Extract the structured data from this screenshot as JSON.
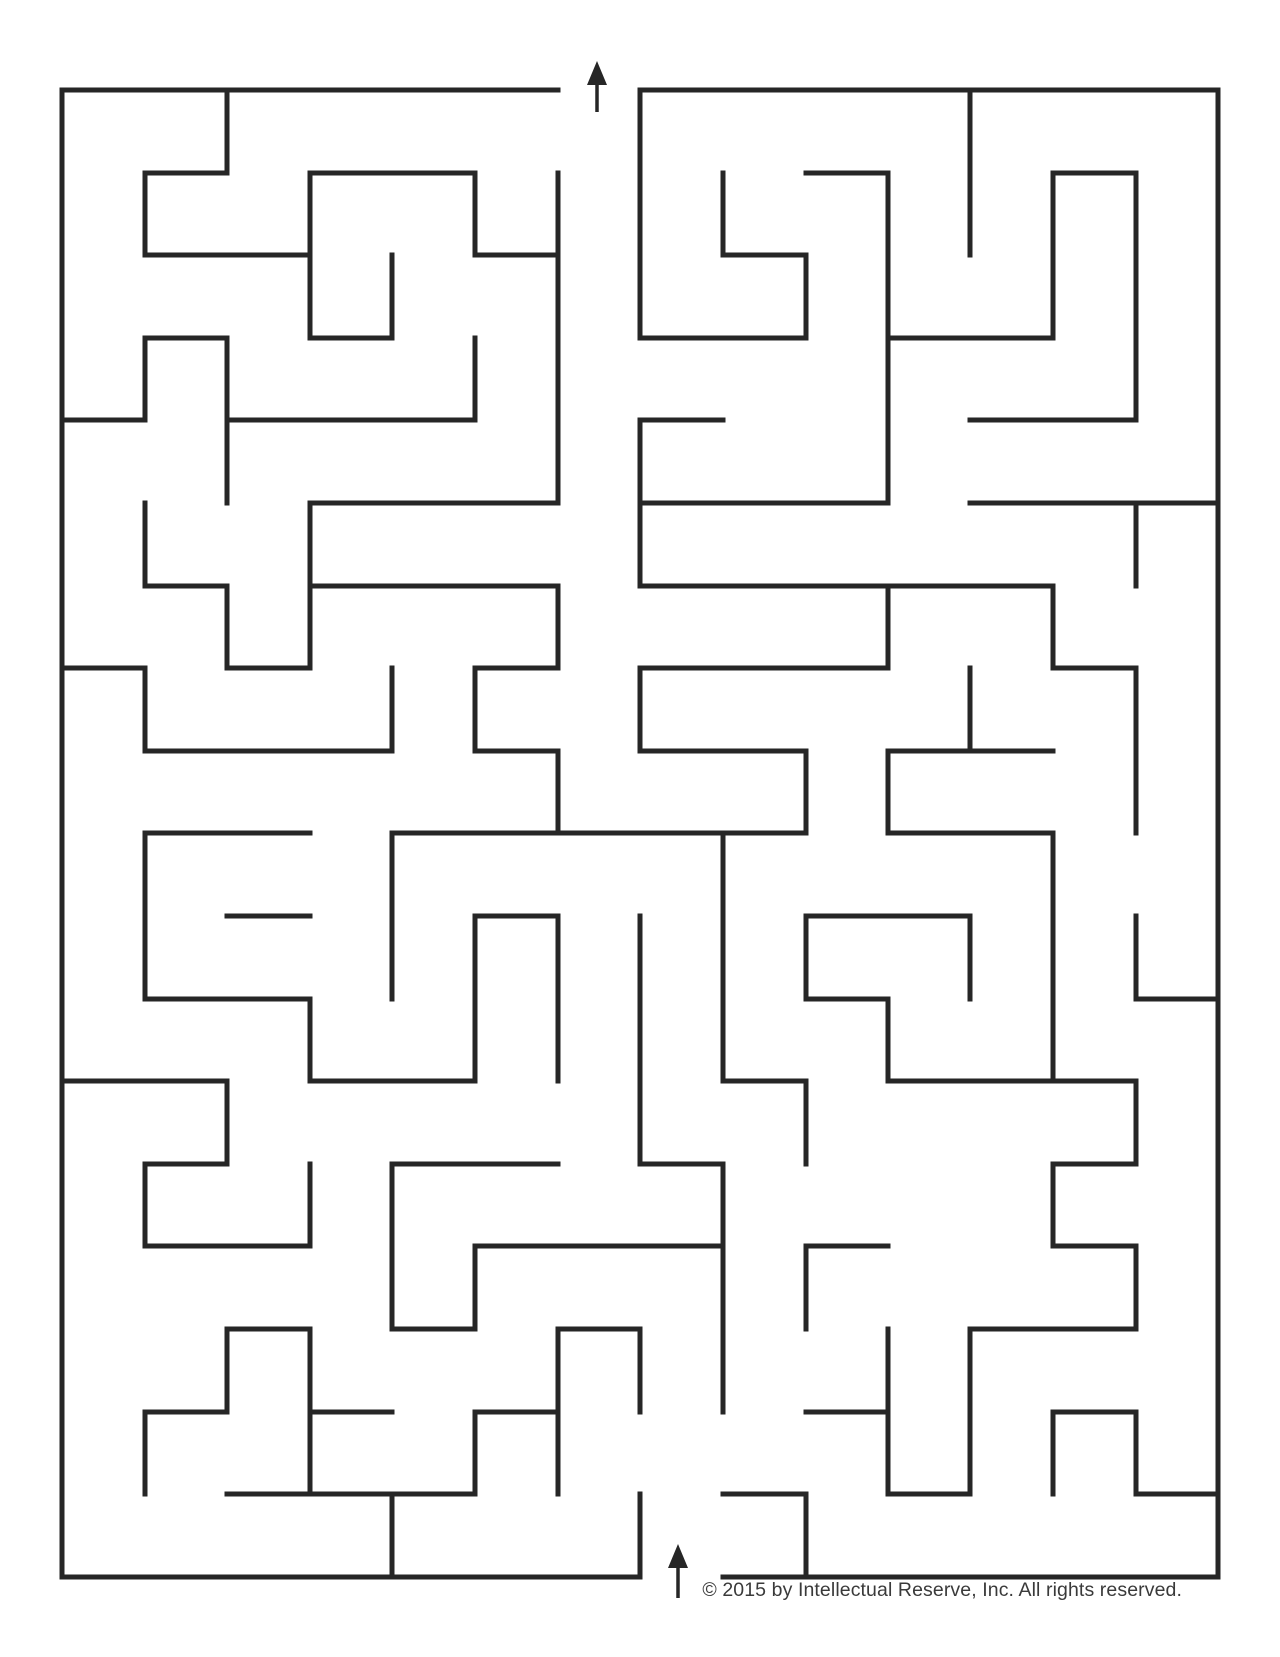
{
  "maze": {
    "width": 1280,
    "height": 1657,
    "wall_color": "#262626",
    "wall_thickness": 5,
    "cols_x": [
      62,
      145,
      227,
      310,
      392,
      475,
      558,
      640,
      723,
      806,
      888,
      970,
      1053,
      1136,
      1218
    ],
    "rows_y": [
      90,
      173,
      255,
      338,
      420,
      503,
      586,
      668,
      751,
      833,
      916,
      999,
      1081,
      1164,
      1246,
      1329,
      1412,
      1494,
      1577
    ],
    "h_walls": [
      [
        0,
        0,
        6
      ],
      [
        0,
        7,
        14
      ],
      [
        1,
        1,
        2
      ],
      [
        1,
        3,
        5
      ],
      [
        1,
        9,
        10
      ],
      [
        1,
        12,
        13
      ],
      [
        2,
        1,
        3
      ],
      [
        2,
        5,
        6
      ],
      [
        2,
        8,
        9
      ],
      [
        3,
        1,
        2
      ],
      [
        3,
        3,
        4
      ],
      [
        3,
        7,
        9
      ],
      [
        3,
        10,
        12
      ],
      [
        4,
        0,
        1
      ],
      [
        4,
        2,
        5
      ],
      [
        4,
        7,
        8
      ],
      [
        4,
        11,
        13
      ],
      [
        5,
        3,
        6
      ],
      [
        5,
        7,
        10
      ],
      [
        5,
        11,
        14
      ],
      [
        6,
        1,
        2
      ],
      [
        6,
        3,
        6
      ],
      [
        6,
        7,
        12
      ],
      [
        7,
        0,
        1
      ],
      [
        7,
        2,
        3
      ],
      [
        7,
        5,
        6
      ],
      [
        7,
        7,
        10
      ],
      [
        7,
        12,
        13
      ],
      [
        8,
        1,
        4
      ],
      [
        8,
        5,
        6
      ],
      [
        8,
        7,
        9
      ],
      [
        8,
        10,
        12
      ],
      [
        9,
        1,
        3
      ],
      [
        9,
        4,
        9
      ],
      [
        9,
        10,
        12
      ],
      [
        10,
        2,
        3
      ],
      [
        10,
        5,
        6
      ],
      [
        10,
        9,
        11
      ],
      [
        11,
        1,
        3
      ],
      [
        11,
        9,
        10
      ],
      [
        11,
        13,
        14
      ],
      [
        12,
        0,
        2
      ],
      [
        12,
        3,
        5
      ],
      [
        12,
        8,
        9
      ],
      [
        12,
        10,
        13
      ],
      [
        13,
        1,
        2
      ],
      [
        13,
        4,
        6
      ],
      [
        13,
        7,
        8
      ],
      [
        13,
        12,
        13
      ],
      [
        14,
        1,
        3
      ],
      [
        14,
        5,
        8
      ],
      [
        14,
        9,
        10
      ],
      [
        14,
        12,
        13
      ],
      [
        15,
        2,
        3
      ],
      [
        15,
        4,
        5
      ],
      [
        15,
        6,
        7
      ],
      [
        15,
        11,
        13
      ],
      [
        16,
        1,
        2
      ],
      [
        16,
        3,
        4
      ],
      [
        16,
        5,
        6
      ],
      [
        16,
        9,
        10
      ],
      [
        16,
        12,
        13
      ],
      [
        17,
        2,
        5
      ],
      [
        17,
        8,
        9
      ],
      [
        17,
        10,
        11
      ],
      [
        17,
        13,
        14
      ],
      [
        18,
        0,
        7
      ],
      [
        18,
        8,
        14
      ]
    ],
    "v_walls": [
      [
        0,
        0,
        18
      ],
      [
        1,
        1,
        2
      ],
      [
        1,
        3,
        4
      ],
      [
        1,
        5,
        6
      ],
      [
        1,
        7,
        8
      ],
      [
        1,
        9,
        11
      ],
      [
        1,
        13,
        14
      ],
      [
        1,
        16,
        17
      ],
      [
        2,
        0,
        1
      ],
      [
        2,
        3,
        5
      ],
      [
        2,
        6,
        7
      ],
      [
        2,
        12,
        13
      ],
      [
        2,
        15,
        16
      ],
      [
        3,
        1,
        3
      ],
      [
        3,
        5,
        7
      ],
      [
        3,
        11,
        12
      ],
      [
        3,
        13,
        14
      ],
      [
        3,
        15,
        17
      ],
      [
        4,
        2,
        3
      ],
      [
        4,
        7,
        8
      ],
      [
        4,
        9,
        11
      ],
      [
        4,
        13,
        15
      ],
      [
        4,
        17,
        18
      ],
      [
        5,
        1,
        2
      ],
      [
        5,
        3,
        4
      ],
      [
        5,
        7,
        8
      ],
      [
        5,
        10,
        12
      ],
      [
        5,
        14,
        15
      ],
      [
        5,
        16,
        17
      ],
      [
        6,
        1,
        5
      ],
      [
        6,
        6,
        7
      ],
      [
        6,
        8,
        9
      ],
      [
        6,
        10,
        12
      ],
      [
        6,
        15,
        17
      ],
      [
        7,
        0,
        3
      ],
      [
        7,
        4,
        6
      ],
      [
        7,
        7,
        8
      ],
      [
        7,
        10,
        13
      ],
      [
        7,
        15,
        16
      ],
      [
        7,
        17,
        18
      ],
      [
        8,
        1,
        2
      ],
      [
        8,
        9,
        12
      ],
      [
        8,
        13,
        16
      ],
      [
        9,
        2,
        3
      ],
      [
        9,
        8,
        9
      ],
      [
        9,
        10,
        11
      ],
      [
        9,
        12,
        13
      ],
      [
        9,
        14,
        15
      ],
      [
        9,
        17,
        18
      ],
      [
        10,
        1,
        5
      ],
      [
        10,
        6,
        7
      ],
      [
        10,
        8,
        9
      ],
      [
        10,
        11,
        12
      ],
      [
        10,
        15,
        17
      ],
      [
        11,
        0,
        2
      ],
      [
        11,
        7,
        8
      ],
      [
        11,
        10,
        11
      ],
      [
        11,
        15,
        17
      ],
      [
        12,
        1,
        3
      ],
      [
        12,
        6,
        7
      ],
      [
        12,
        9,
        12
      ],
      [
        12,
        13,
        14
      ],
      [
        12,
        16,
        17
      ],
      [
        13,
        1,
        4
      ],
      [
        13,
        5,
        6
      ],
      [
        13,
        7,
        9
      ],
      [
        13,
        10,
        11
      ],
      [
        13,
        12,
        13
      ],
      [
        13,
        14,
        15
      ],
      [
        13,
        16,
        17
      ],
      [
        14,
        0,
        18
      ]
    ],
    "exit_arrow": {
      "x": 597,
      "tip_y": 61,
      "tail_y": 112,
      "head_w": 20,
      "head_h": 24,
      "shaft_w": 3.5
    },
    "entry_arrow": {
      "x": 678,
      "tip_y": 1544,
      "tail_y": 1598,
      "head_w": 20,
      "head_h": 24,
      "shaft_w": 3.5
    }
  },
  "footer": {
    "copyright": "© 2015 by Intellectual Reserve, Inc. All rights reserved."
  }
}
